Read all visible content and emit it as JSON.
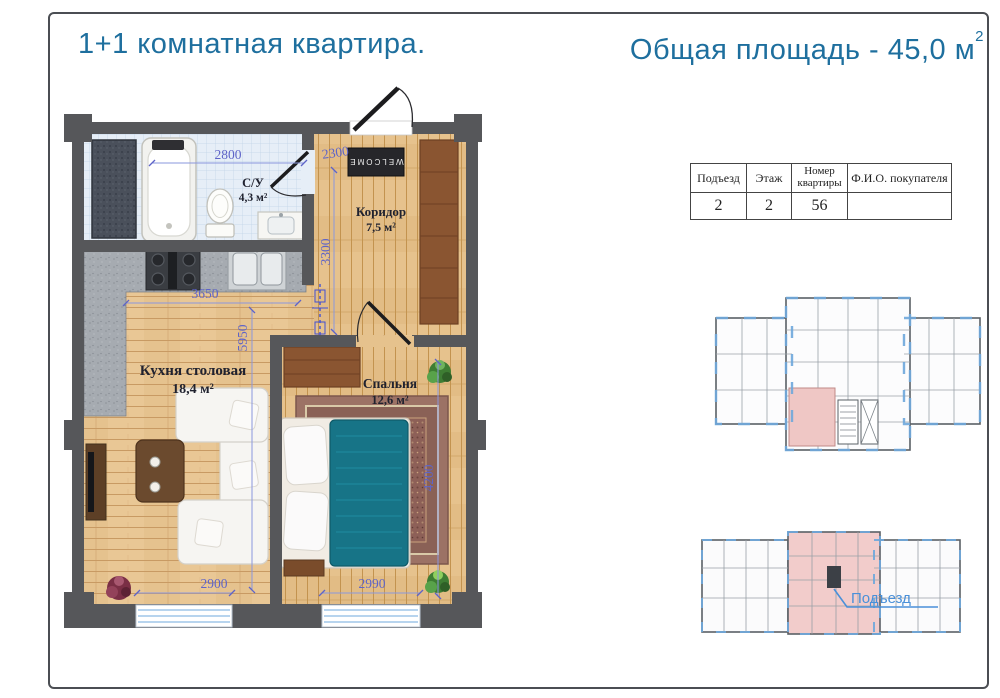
{
  "header": {
    "title_left": "1+1 комнатная квартира.",
    "title_right": "Общая площадь - 45,0 м",
    "title_right_sup": "2"
  },
  "info_table": {
    "col_podezd": "Подъезд",
    "col_etazh": "Этаж",
    "col_nomer_line1": "Номер",
    "col_nomer_line2": "квартиры",
    "col_fio": "Ф.И.О. покупателя",
    "val_podezd": "2",
    "val_etazh": "2",
    "val_nomer": "56",
    "val_fio": ""
  },
  "floor_plan": {
    "bath_name": "С/У",
    "bath_area": "4,3 м²",
    "hall_name": "Коридор",
    "hall_area": "7,5 м²",
    "kitchen_name": "Кухня столовая",
    "kitchen_area": "18,4 м²",
    "bedroom_name": "Спальня",
    "bedroom_area": "12,6 м²",
    "dim_bath_top": "2800",
    "dim_hall_top": "2300",
    "dim_hall_side": "3300",
    "dim_kitchen_top": "3650",
    "dim_kitchen_side": "5950",
    "dim_window_left": "2900",
    "dim_window_right": "2990",
    "dim_bedroom_side": "4200",
    "doormat": "WELCOME"
  },
  "site_plan": {
    "entrance_label": "Подъезд"
  },
  "colors": {
    "accent_title": "#1e6f9e",
    "dimension_text": "#5e64c8",
    "room_label": "#20222f",
    "wall": "#56575a",
    "wood_floor": "#e9c795",
    "bath_tile": "#e6eef7",
    "wardrobe_wood": "#8a5531",
    "bed_blanket": "#177487",
    "highlight_apartment": "#f2cccb",
    "entrance_label_color": "#4a90d9",
    "window_glass": "#9fc6e8"
  }
}
